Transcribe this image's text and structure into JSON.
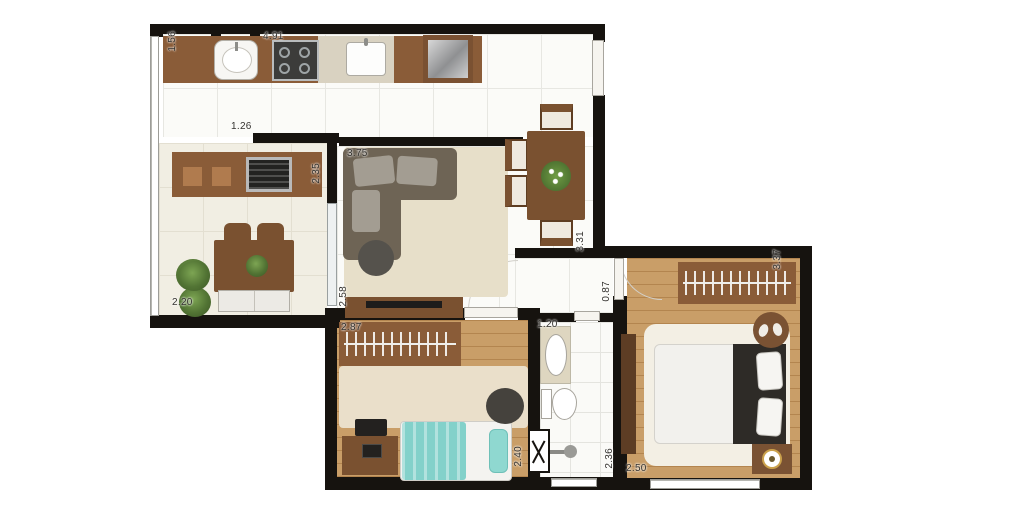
{
  "plan": {
    "type": "apartment-floor-plan",
    "unit": "m",
    "dims": {
      "kitchen_depth": "1.56",
      "kitchen_length": "4.91",
      "kitchen_opening": "1.26",
      "balcony_depth": "2.35",
      "balcony_length": "2.20",
      "living_width": "3.75",
      "living_tv_wall": "2.58",
      "living_length": "3.31",
      "hall_width": "0.87",
      "bedroom2_width": "2.87",
      "bedroom2_length": "2.40",
      "bathroom_width": "1.20",
      "bathroom_length": "2.36",
      "bedroom1_length": "3.37",
      "bedroom1_width": "2.50"
    },
    "palette": {
      "wall": "#16130f",
      "wood_floor": "#c99e68",
      "furniture_brown": "#8a5c38",
      "teal_bedding": "#83d1ca",
      "rug_beige": "#e7dfc9"
    }
  }
}
